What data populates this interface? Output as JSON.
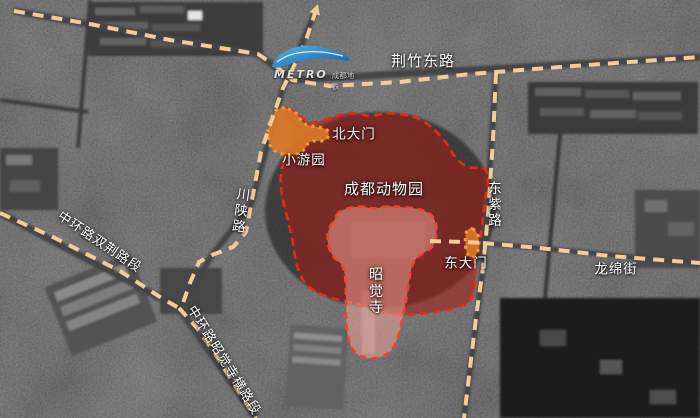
{
  "map": {
    "canvas": {
      "width": 700,
      "height": 418
    },
    "colors": {
      "road_dash": "#f3cd97",
      "zone_fill": "rgba(165,25,18,0.55)",
      "zone_border": "#e52c16",
      "inner_fill": "rgba(246,165,150,0.52)",
      "inner_border": "#ee4530",
      "orange_fill": "rgba(217,121,40,0.92)",
      "orange_border": "#ff9832",
      "label_color": "#ffffff",
      "metro_blue": "#2a8fd8"
    },
    "metro": {
      "brand": "METRO",
      "cn": "成都地铁"
    },
    "roads": [
      {
        "id": "jingzhu-east-road",
        "points": [
          [
            14,
            11
          ],
          [
            90,
            24
          ],
          [
            170,
            40
          ],
          [
            258,
            54
          ],
          [
            276,
            66
          ],
          [
            292,
            80
          ],
          [
            330,
            86
          ],
          [
            400,
            82
          ],
          [
            470,
            74
          ],
          [
            560,
            67
          ],
          [
            630,
            62
          ],
          [
            700,
            57
          ]
        ]
      },
      {
        "id": "chuanshan-road",
        "arrow": "start",
        "points": [
          [
            316,
            10
          ],
          [
            306,
            40
          ],
          [
            293,
            68
          ],
          [
            283,
            88
          ],
          [
            270,
            125
          ],
          [
            261,
            152
          ],
          [
            251,
            205
          ],
          [
            246,
            232
          ],
          [
            233,
            247
          ],
          [
            212,
            255
          ],
          [
            199,
            262
          ],
          [
            190,
            283
          ],
          [
            183,
            303
          ]
        ]
      },
      {
        "id": "zhonghuan-shuangjing-road",
        "points": [
          [
            0,
            213
          ],
          [
            55,
            238
          ],
          [
            120,
            271
          ],
          [
            163,
            299
          ],
          [
            179,
            308
          ]
        ]
      },
      {
        "id": "zhonghuan-zhaojuesi-road",
        "points": [
          [
            179,
            308
          ],
          [
            197,
            328
          ],
          [
            214,
            352
          ],
          [
            237,
            389
          ],
          [
            256,
            418
          ]
        ]
      },
      {
        "id": "dongzi-road",
        "points": [
          [
            496,
            73
          ],
          [
            493,
            140
          ],
          [
            488,
            215
          ],
          [
            483,
            268
          ],
          [
            477,
            310
          ],
          [
            470,
            368
          ],
          [
            464,
            418
          ]
        ]
      },
      {
        "id": "longmian-street",
        "points": [
          [
            483,
            243
          ],
          [
            540,
            248
          ],
          [
            610,
            256
          ],
          [
            700,
            263
          ]
        ]
      },
      {
        "id": "east-gate-spur",
        "points": [
          [
            430,
            241
          ],
          [
            465,
            242
          ],
          [
            483,
            243
          ]
        ]
      }
    ],
    "zones": [
      {
        "id": "zone-chengdu-zoo",
        "kind": "outer",
        "points": [
          [
            281,
            106
          ],
          [
            297,
            112
          ],
          [
            308,
            124
          ],
          [
            322,
            121
          ],
          [
            338,
            115
          ],
          [
            355,
            112
          ],
          [
            369,
            117
          ],
          [
            385,
            113
          ],
          [
            399,
            114
          ],
          [
            413,
            116
          ],
          [
            425,
            122
          ],
          [
            437,
            132
          ],
          [
            448,
            145
          ],
          [
            455,
            158
          ],
          [
            469,
            169
          ],
          [
            485,
            166
          ],
          [
            489,
            179
          ],
          [
            485,
            199
          ],
          [
            482,
            226
          ],
          [
            479,
            247
          ],
          [
            473,
            258
          ],
          [
            476,
            272
          ],
          [
            474,
            292
          ],
          [
            469,
            304
          ],
          [
            452,
            309
          ],
          [
            436,
            312
          ],
          [
            419,
            314
          ],
          [
            399,
            315
          ],
          [
            377,
            312
          ],
          [
            357,
            303
          ],
          [
            337,
            300
          ],
          [
            317,
            293
          ],
          [
            303,
            282
          ],
          [
            296,
            264
          ],
          [
            293,
            242
          ],
          [
            288,
            220
          ],
          [
            283,
            201
          ],
          [
            280,
            184
          ],
          [
            282,
            167
          ],
          [
            286,
            151
          ],
          [
            293,
            142
          ],
          [
            296,
            129
          ],
          [
            287,
            116
          ]
        ]
      },
      {
        "id": "patch-xiaoyouyuan",
        "kind": "orange",
        "points": [
          [
            279,
            106
          ],
          [
            297,
            112
          ],
          [
            302,
            123
          ],
          [
            311,
            126
          ],
          [
            330,
            129
          ],
          [
            327,
            142
          ],
          [
            309,
            140
          ],
          [
            304,
            152
          ],
          [
            288,
            156
          ],
          [
            271,
            150
          ],
          [
            267,
            135
          ],
          [
            270,
            118
          ]
        ]
      },
      {
        "id": "patch-east-gate",
        "kind": "orange",
        "points": [
          [
            469,
            228
          ],
          [
            476,
            230
          ],
          [
            479,
            238
          ],
          [
            479,
            248
          ],
          [
            476,
            256
          ],
          [
            470,
            258
          ],
          [
            466,
            252
          ],
          [
            465,
            240
          ],
          [
            466,
            232
          ]
        ]
      },
      {
        "id": "zone-zhaojue-temple",
        "kind": "inner",
        "points": [
          [
            335,
            219
          ],
          [
            338,
            212
          ],
          [
            348,
            208
          ],
          [
            362,
            206
          ],
          [
            374,
            209
          ],
          [
            386,
            206
          ],
          [
            400,
            207
          ],
          [
            414,
            208
          ],
          [
            426,
            211
          ],
          [
            433,
            216
          ],
          [
            437,
            226
          ],
          [
            436,
            238
          ],
          [
            433,
            247
          ],
          [
            425,
            252
          ],
          [
            417,
            257
          ],
          [
            412,
            265
          ],
          [
            409,
            280
          ],
          [
            407,
            296
          ],
          [
            404,
            310
          ],
          [
            401,
            325
          ],
          [
            398,
            338
          ],
          [
            393,
            349
          ],
          [
            385,
            356
          ],
          [
            373,
            359
          ],
          [
            361,
            357
          ],
          [
            352,
            350
          ],
          [
            348,
            338
          ],
          [
            346,
            322
          ],
          [
            346,
            306
          ],
          [
            346,
            290
          ],
          [
            345,
            274
          ],
          [
            342,
            264
          ],
          [
            334,
            258
          ],
          [
            329,
            249
          ],
          [
            327,
            238
          ],
          [
            329,
            228
          ]
        ]
      }
    ],
    "labels": [
      {
        "id": "road-jingzhudonglu",
        "text": "荆竹东路",
        "x": 423,
        "y": 61,
        "size": 15
      },
      {
        "id": "gate-north",
        "text": "北大门",
        "x": 354,
        "y": 135,
        "size": 13.5
      },
      {
        "id": "xiaoyouyuan",
        "text": "小游园",
        "x": 304,
        "y": 161,
        "size": 13.5
      },
      {
        "id": "chengdu-zoo",
        "text": "成都动物园",
        "x": 384,
        "y": 189,
        "size": 15
      },
      {
        "id": "road-chuanshanlu",
        "text": "川陕路",
        "x": 241,
        "y": 212,
        "size": 13.5,
        "vertical": true,
        "rotate": 8
      },
      {
        "id": "road-zhonghuan-shuangjing",
        "text": "中环路双荆路段",
        "x": 99,
        "y": 243,
        "size": 13,
        "rotate": 34
      },
      {
        "id": "road-dongzilu",
        "text": "东紫路",
        "x": 495,
        "y": 206,
        "size": 13.5,
        "vertical": true
      },
      {
        "id": "gate-east",
        "text": "东大门",
        "x": 466,
        "y": 264,
        "size": 13.5
      },
      {
        "id": "road-longmianjie",
        "text": "龙绵街",
        "x": 616,
        "y": 270,
        "size": 13.5
      },
      {
        "id": "zhaojue-temple",
        "text": "昭觉寺",
        "x": 376,
        "y": 292,
        "size": 14,
        "vertical": true
      },
      {
        "id": "road-zhonghuan-zhaojuesi",
        "text": "中环路昭觉寺横路段",
        "x": 223,
        "y": 361,
        "size": 13,
        "rotate": 58
      }
    ]
  }
}
